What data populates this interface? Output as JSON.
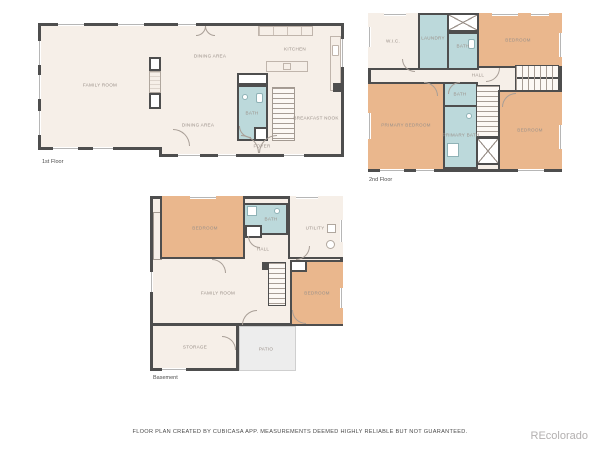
{
  "colors": {
    "wall": "#4e4e4e",
    "floor": "#f6efe8",
    "bedroom": "#eab78d",
    "wet": "#bcd9db",
    "patio": "#ededed"
  },
  "floors": [
    {
      "label": "1st Floor",
      "rooms": {
        "family_room": "FAMILY ROOM",
        "dining_top": "DINING AREA",
        "kitchen": "KITCHEN",
        "dining_bottom": "DINING AREA",
        "bath": "BATH",
        "breakfast_nook": "BREAKFAST NOOK",
        "foyer": "FOYER"
      }
    },
    {
      "label": "2nd Floor",
      "rooms": {
        "wic": "W.I.C.",
        "laundry": "LAUNDRY",
        "bath_top": "BATH",
        "bedroom_top": "BEDROOM",
        "hall": "HALL",
        "primary_bedroom": "PRIMARY BEDROOM",
        "bath_mid": "BATH",
        "primary_bath": "PRIMARY BATH",
        "bedroom_right": "BEDROOM"
      }
    },
    {
      "label": "Basement",
      "rooms": {
        "bedroom_top": "BEDROOM",
        "bath": "BATH",
        "utility": "UTILITY",
        "hall": "HALL",
        "family_room": "FAMILY ROOM",
        "bedroom_right": "BEDROOM",
        "storage": "STORAGE",
        "patio": "PATIO"
      }
    }
  ],
  "footer": {
    "disclaimer": "FLOOR PLAN CREATED BY CUBICASA APP. MEASUREMENTS DEEMED HIGHLY RELIABLE BUT NOT GUARANTEED.",
    "watermark": "REcolorado"
  }
}
